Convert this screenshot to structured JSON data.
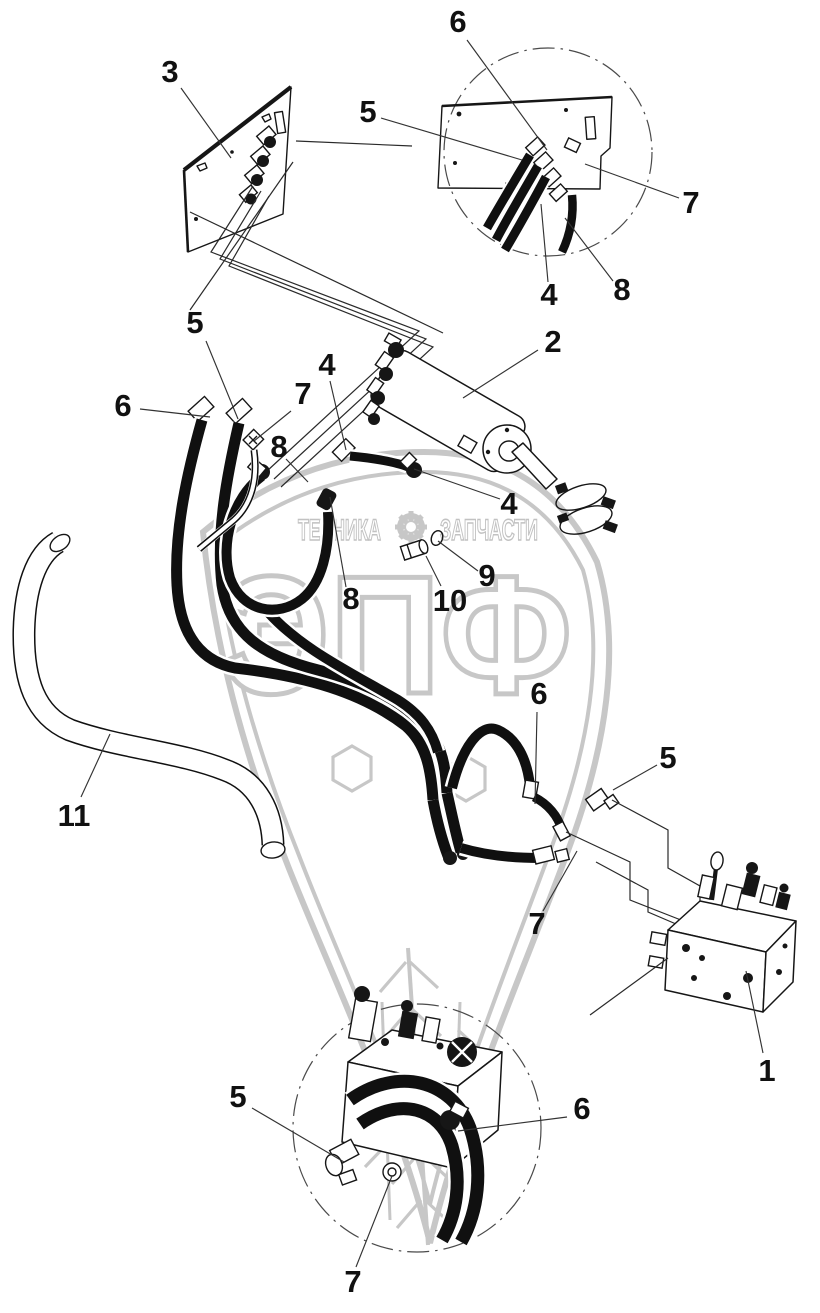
{
  "watermark": {
    "text_left": "ТЕХНИКА",
    "text_right": "ЗАПЧАСТИ",
    "logo_text": "ЭПФ",
    "color": "#c7c7c7"
  },
  "colors": {
    "background": "#ffffff",
    "line": "#161616",
    "leader": "#333333",
    "watermark": "#c7c7c7"
  },
  "callouts": [
    {
      "label": "3",
      "x": 170,
      "y": 82,
      "leader": [
        181,
        88,
        231,
        158
      ]
    },
    {
      "label": "6",
      "x": 458,
      "y": 32,
      "leader": [
        467,
        40,
        547,
        150
      ]
    },
    {
      "label": "5",
      "x": 368,
      "y": 122,
      "leader": [
        381,
        118,
        522,
        160
      ]
    },
    {
      "label": "7",
      "x": 691,
      "y": 213,
      "leader": [
        679,
        198,
        585,
        164
      ]
    },
    {
      "label": "4",
      "x": 549,
      "y": 305,
      "leader": [
        548,
        282,
        541,
        204
      ]
    },
    {
      "label": "8",
      "x": 622,
      "y": 300,
      "leader": [
        613,
        281,
        565,
        218
      ]
    },
    {
      "label": "2",
      "x": 553,
      "y": 352,
      "leader": [
        538,
        350,
        463,
        398
      ]
    },
    {
      "label": "5",
      "x": 195,
      "y": 333,
      "leader": [
        206,
        341,
        238,
        419
      ]
    },
    {
      "label": "4",
      "x": 327,
      "y": 375,
      "leader": [
        330,
        381,
        346,
        450
      ]
    },
    {
      "label": "7",
      "x": 303,
      "y": 404,
      "leader": [
        291,
        411,
        254,
        441
      ]
    },
    {
      "label": "6",
      "x": 123,
      "y": 416,
      "leader": [
        140,
        409,
        210,
        417
      ]
    },
    {
      "label": "8",
      "x": 279,
      "y": 457,
      "leader": [
        286,
        459,
        308,
        482
      ]
    },
    {
      "label": "4",
      "x": 509,
      "y": 514,
      "leader": [
        500,
        499,
        414,
        469
      ]
    },
    {
      "label": "9",
      "x": 487,
      "y": 586,
      "leader": [
        478,
        571,
        438,
        541
      ]
    },
    {
      "label": "10",
      "x": 450,
      "y": 611,
      "leader": [
        441,
        586,
        426,
        556
      ]
    },
    {
      "label": "8",
      "x": 351,
      "y": 609,
      "leader": [
        346,
        587,
        330,
        497
      ]
    },
    {
      "label": "6",
      "x": 539,
      "y": 704,
      "leader": [
        537,
        712,
        535,
        804
      ]
    },
    {
      "label": "5",
      "x": 668,
      "y": 768,
      "leader": [
        657,
        765,
        613,
        790
      ]
    },
    {
      "label": "11",
      "x": 74,
      "y": 826,
      "leader": [
        81,
        797,
        110,
        734
      ]
    },
    {
      "label": "7",
      "x": 537,
      "y": 934,
      "leader": [
        543,
        911,
        577,
        851
      ]
    },
    {
      "label": "1",
      "x": 767,
      "y": 1081,
      "leader": [
        763,
        1053,
        746,
        971
      ]
    },
    {
      "label": "5",
      "x": 238,
      "y": 1107,
      "leader": [
        252,
        1108,
        344,
        1162
      ]
    },
    {
      "label": "6",
      "x": 582,
      "y": 1119,
      "leader": [
        567,
        1117,
        458,
        1131
      ]
    },
    {
      "label": "7",
      "x": 353,
      "y": 1292,
      "leader": [
        356,
        1267,
        392,
        1176
      ]
    }
  ]
}
